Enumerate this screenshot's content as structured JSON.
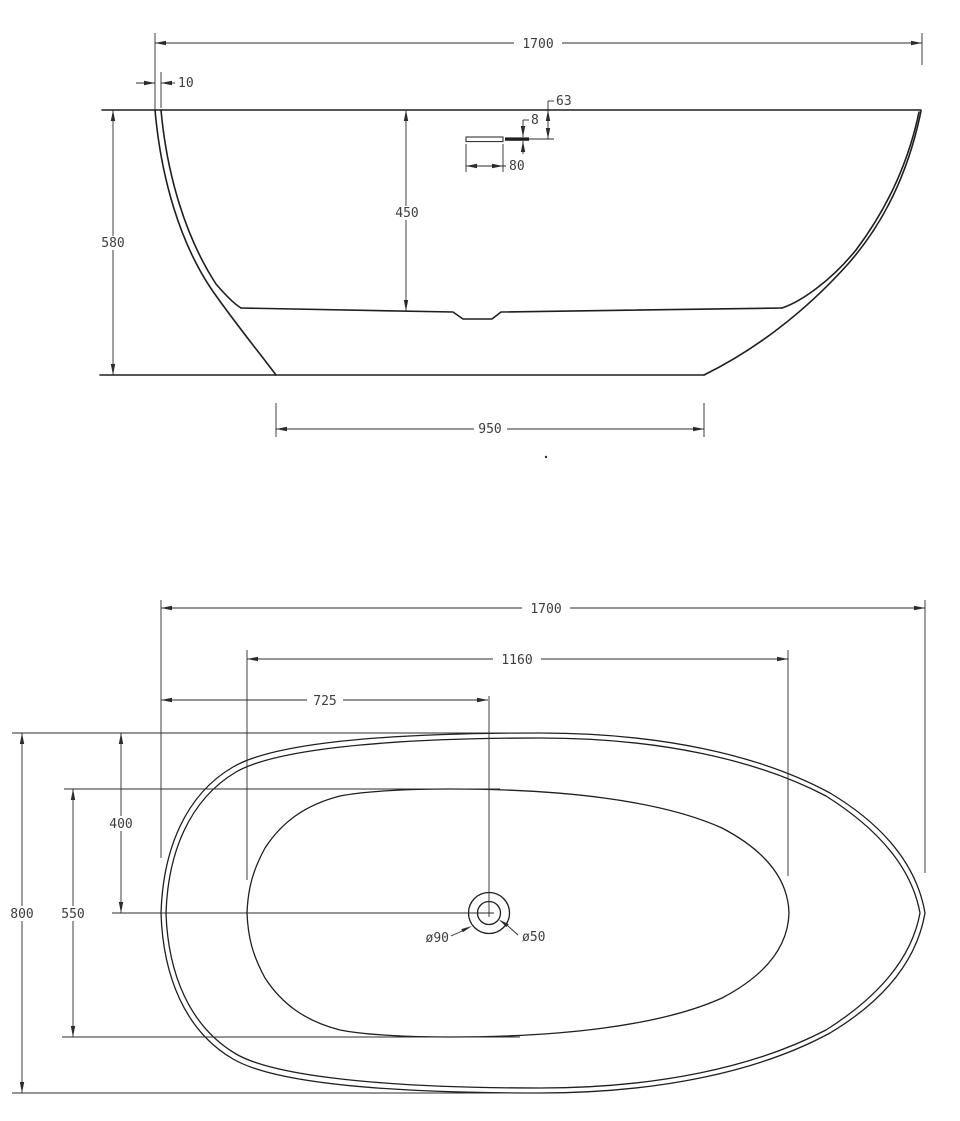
{
  "side_view": {
    "dim_overall_length": "1700",
    "dim_rim_thickness": "10",
    "dim_overflow_drop": "63",
    "dim_overflow_slot_height": "8",
    "dim_overflow_slot_width": "80",
    "dim_inner_depth": "450",
    "dim_overall_height": "580",
    "dim_base_length": "950"
  },
  "plan_view": {
    "dim_overall_length": "1700",
    "dim_inner_length": "1160",
    "dim_drain_from_left": "725",
    "dim_center_from_top": "400",
    "dim_inner_width": "550",
    "dim_overall_width": "800",
    "label_drain_outer_dia": "ø90",
    "label_drain_inner_dia": "ø50"
  },
  "style": {
    "line_color": "#2b2b2b",
    "text_color": "#3d3d3d",
    "background": "#ffffff"
  }
}
